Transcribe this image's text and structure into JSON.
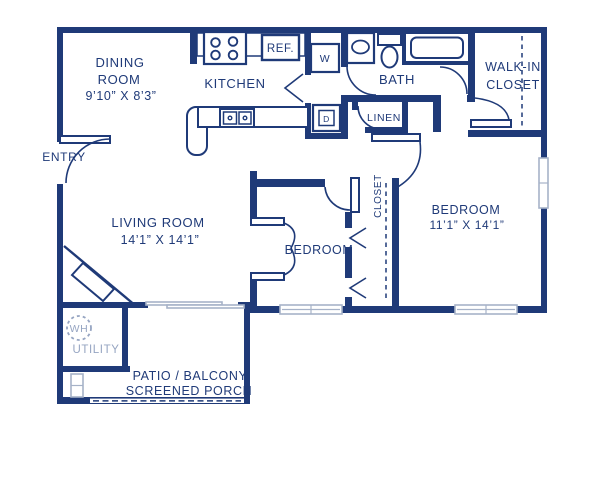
{
  "colors": {
    "wall": "#1f3a78",
    "text_navy": "#1f3a78",
    "window_light": "#a6b2c8",
    "muted_text": "#96a5c2",
    "background": "#ffffff"
  },
  "rooms": {
    "dining": {
      "line1": "DINING",
      "line2": "ROOM",
      "dims": "9’10” X 8’3”"
    },
    "kitchen": {
      "name": "KITCHEN"
    },
    "bath": {
      "name": "BATH"
    },
    "walkin_closet": {
      "line1": "WALK-IN",
      "line2": "CLOSET"
    },
    "linen": {
      "name": "LINEN"
    },
    "entry": {
      "name": "ENTRY"
    },
    "living": {
      "name": "LIVING ROOM",
      "dims": "14’1” X 14’1”"
    },
    "bedroom_small": {
      "name": "BEDROOM"
    },
    "closet": {
      "name": "CLOSET"
    },
    "bedroom_large": {
      "name": "BEDROOM",
      "dims": "11’1” X 14’1”"
    },
    "utility": {
      "name": "UTILITY",
      "water_heater": "WH"
    },
    "patio": {
      "line1": "PATIO / BALCONY",
      "line2": "SCREENED PORCH"
    }
  },
  "appliances": {
    "refrigerator": "REF.",
    "washer": "W",
    "dryer": "D"
  }
}
